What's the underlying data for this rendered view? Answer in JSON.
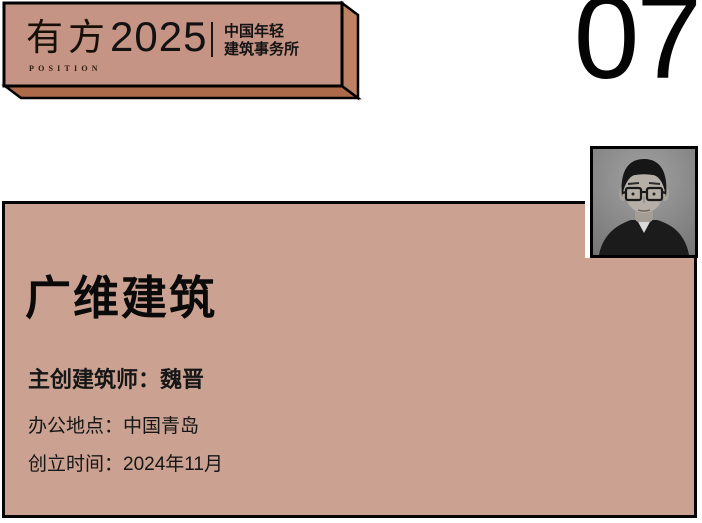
{
  "banner": {
    "logo": {
      "text": "有方",
      "subtext": "POSITION"
    },
    "year": "2025",
    "tagline": {
      "line1": "中国年轻",
      "line2": "建筑事务所"
    }
  },
  "page_number": "07",
  "profile_card": {
    "title": "广维建筑",
    "architect": "主创建筑师：魏晋",
    "location": "办公地点：中国青岛",
    "founded": "创立时间：2024年11月"
  },
  "photo": {
    "description": "grayscale portrait of architect wearing glasses"
  },
  "colors": {
    "banner_face": "#c69484",
    "banner_side": "#bd8164",
    "banner_bottom": "#ac6a4b",
    "card_background": "#cba291",
    "ink": "#0c0c0c"
  }
}
